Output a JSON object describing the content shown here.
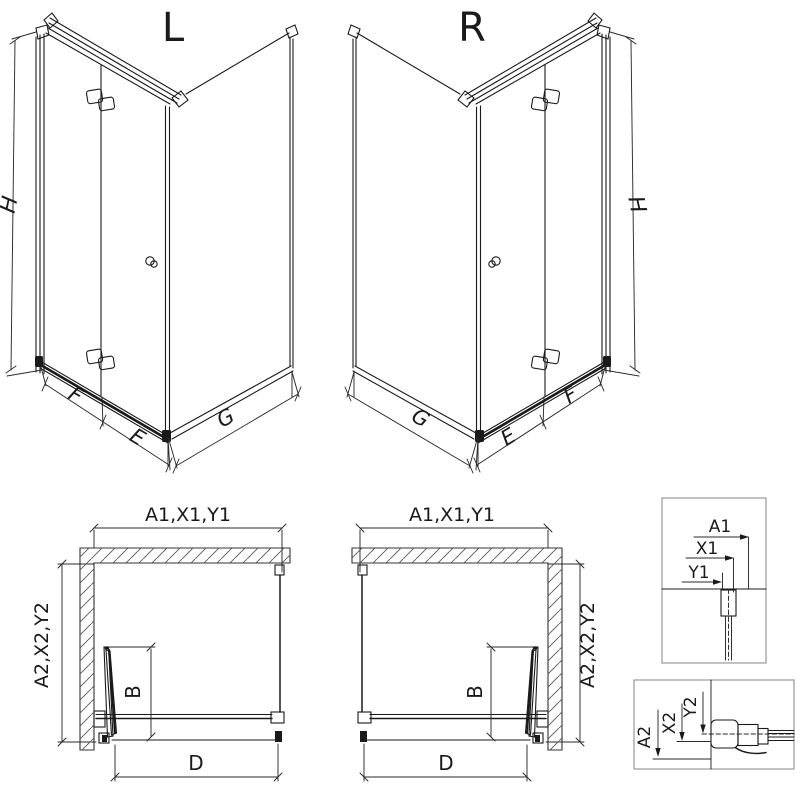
{
  "page": {
    "background": "#ffffff",
    "line_color": "#1a1a1a",
    "detail_box_border_color": "#999999"
  },
  "perspective_views": {
    "left": {
      "variant": "L",
      "height_dim": "H",
      "door_panel_dim": "F",
      "inner_width_dim": "E",
      "side_panel_dim": "G"
    },
    "right": {
      "variant": "R",
      "height_dim": "H",
      "door_panel_dim": "F",
      "inner_width_dim": "E",
      "side_panel_dim": "G"
    }
  },
  "plan_views": {
    "left": {
      "width_dim": "A1,X1,Y1",
      "depth_dim": "A2,X2,Y2",
      "door_fold_dim": "B",
      "entry_dim": "D"
    },
    "right": {
      "width_dim": "A1,X1,Y1",
      "depth_dim": "A2,X2,Y2",
      "door_fold_dim": "B",
      "entry_dim": "D"
    }
  },
  "details": {
    "top": {
      "dim_a": "A1",
      "dim_x": "X1",
      "dim_y": "Y1"
    },
    "bottom": {
      "dim_a": "A2",
      "dim_x": "X2",
      "dim_y": "Y2"
    }
  }
}
